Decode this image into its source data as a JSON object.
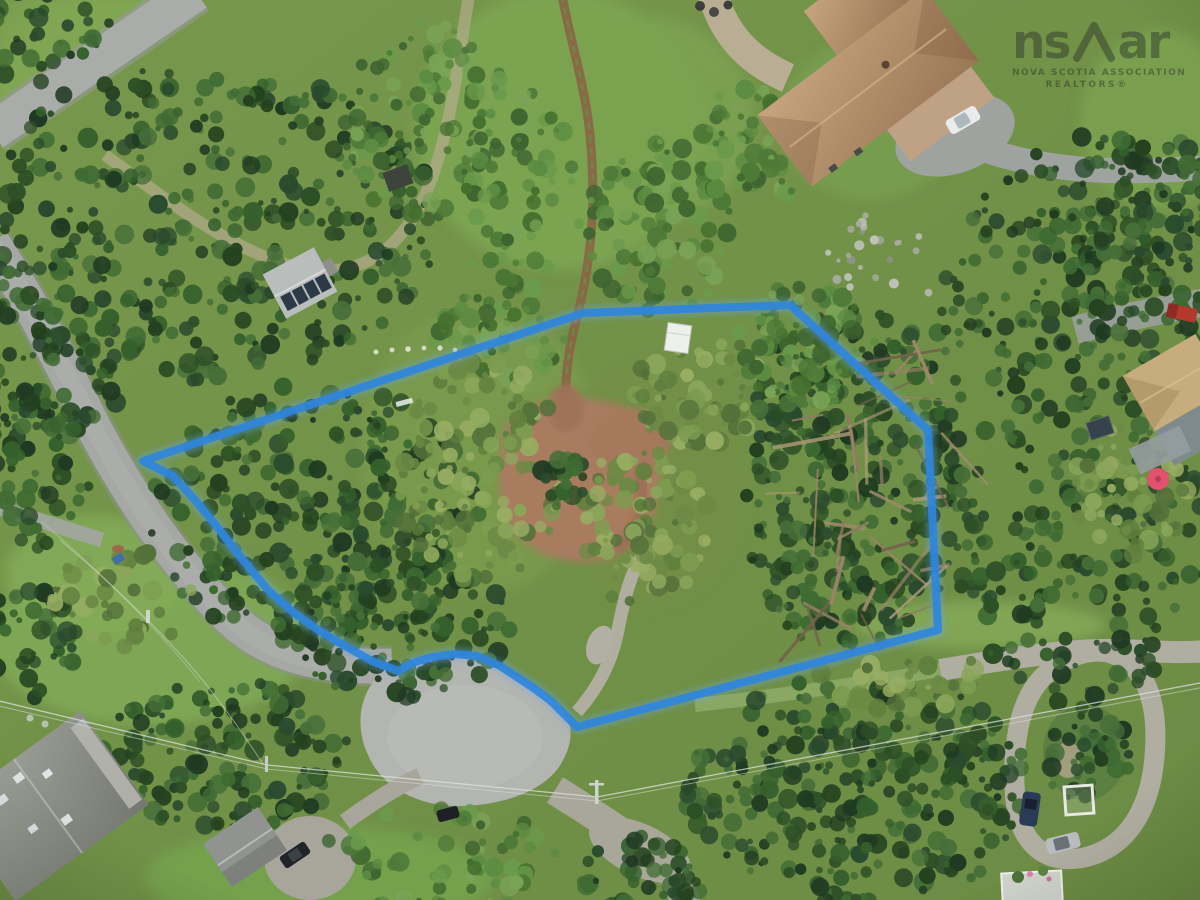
{
  "watermark": {
    "logo_prefix": "ns",
    "logo_suffix": "ar",
    "line1": "NOVA SCOTIA ASSOCIATION",
    "line2": "REALTORS®"
  },
  "overlay": {
    "boundary_color": "#2f86dd",
    "boundary_glow_color": "#6aa9e9",
    "boundary_points": [
      [
        143,
        461
      ],
      [
        583,
        313
      ],
      [
        790,
        305
      ],
      [
        928,
        430
      ],
      [
        938,
        630
      ],
      [
        577,
        727
      ],
      [
        551,
        701
      ],
      [
        535,
        689
      ],
      [
        520,
        679
      ],
      [
        500,
        666
      ],
      [
        477,
        656
      ],
      [
        455,
        654
      ],
      [
        433,
        657
      ],
      [
        415,
        662
      ],
      [
        398,
        671
      ],
      [
        372,
        661
      ],
      [
        345,
        646
      ],
      [
        318,
        630
      ],
      [
        293,
        612
      ],
      [
        268,
        590
      ],
      [
        243,
        560
      ],
      [
        218,
        528
      ],
      [
        195,
        500
      ],
      [
        173,
        476
      ]
    ]
  },
  "palette": {
    "meadow_green": "#74984b",
    "forest_dark_green": "#2d4f26",
    "forest_light_green": "#5c8c42",
    "scrub_olive": "#7d9c50",
    "road_asphalt_gray": "#a5a8a5",
    "culdesac_gray": "#b3b5b1",
    "gravel_tan": "#a9a79a",
    "dirt_brown": "#a97b60",
    "trail_brown": "#8c6044",
    "roof_tan": "#b4946f",
    "roof_gray": "#8d9088",
    "cabin_roof_gray": "#b9bdbb",
    "yellow_house_roof": "#c7ad7d",
    "umbrella_pink": "#e2516d",
    "white_vehicle": "#e9ebed",
    "dark_vehicle": "#202327",
    "blue_vehicle": "#2a3c55",
    "silver_vehicle": "#b9bcbe",
    "red_truck": "#b2392b",
    "powerline_gray": "#dde2e2"
  }
}
